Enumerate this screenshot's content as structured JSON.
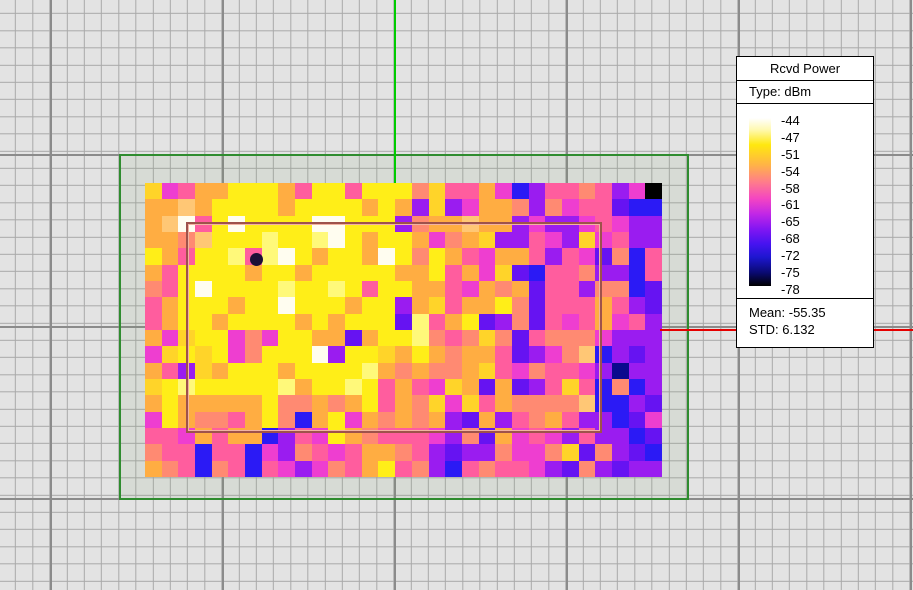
{
  "legend": {
    "title": "Rcvd Power",
    "type_label": "Type: dBm",
    "unit": "dBm",
    "ticks": [
      "-44",
      "-47",
      "-51",
      "-54",
      "-58",
      "-61",
      "-65",
      "-68",
      "-72",
      "-75",
      "-78"
    ],
    "mean_label": "Mean: -55.35",
    "std_label": "STD: 6.132",
    "mean_value": "-55.35",
    "std_value": "6.132",
    "gradient_stops": [
      {
        "color": "#ffffff",
        "pos": 0
      },
      {
        "color": "#fff9b0",
        "pos": 7
      },
      {
        "color": "#ffe80f",
        "pos": 16
      },
      {
        "color": "#ffb347",
        "pos": 28
      },
      {
        "color": "#ff7d8a",
        "pos": 38
      },
      {
        "color": "#f445c2",
        "pos": 48
      },
      {
        "color": "#c227e6",
        "pos": 57
      },
      {
        "color": "#8316f2",
        "pos": 66
      },
      {
        "color": "#4613f0",
        "pos": 75
      },
      {
        "color": "#1d16cf",
        "pos": 83
      },
      {
        "color": "#0a0a72",
        "pos": 92
      },
      {
        "color": "#000000",
        "pos": 100
      }
    ]
  },
  "colors": {
    "background": "#e3e3e3",
    "grid_minor": "#a9a9a9",
    "grid_major": "#8b8b8b",
    "boundary_outline": "#2f8c2f",
    "room_outline": "#9e524b",
    "room_outline_highlight": "#f2b3a2",
    "vertical_axis_line": "#00cc00",
    "horizontal_axis_line": "#e60000",
    "marker_dot": "#1c1036"
  },
  "heatmap": {
    "columns": 31,
    "row_count": 18,
    "marker_cell": {
      "col": 6,
      "row": 4
    },
    "palette": {
      "W": "#fffdf0",
      "Y": "#ffee18",
      "y": "#fff97a",
      "G": "#ffd429",
      "O": "#ffad42",
      "o": "#ffc775",
      "S": "#ff8a72",
      "P": "#ff5d9e",
      "M": "#ee3ed0",
      "V": "#9a1cf0",
      "U": "#6613f2",
      "B": "#2b1af5",
      "D": "#0a0a8e",
      "K": "#000000"
    },
    "rows": [
      "GMPOOYYYOPYYPYYYSGPPOMBVPPSPVMK",
      "OOoOYYYYOYYYYOYOVGVMOOSVSMPPUBB",
      "OoWPYWYYYYWWYYYVSOOoOOVMVVMPMVV",
      "OOSoYYYyYYyWYOYYOMSOGVVPMVGMPVV",
      "YOPYYyPyWYOYYOWYSYOPMOOPVPMUSBP",
      "OPYYYYOYYOYYYYYOOYPOMGUBPPSVVBP",
      "SPYWYYYYyYYyYPYYOOPMOSOUPPVSSBU",
      "POYYYOYYWYYYOYYVOGPOOYSUPPPOPVU",
      "POYYOYYYYOYOYYYUyPOYUVSUPMPOMPV",
      "OMGYYMSMYYOOUOYYySPSGSUPSSSMVVV",
      "MGYGYMSYYYWVYYGOYOSOOPUVMSoBVUV",
      "OPVGOYYYOYYYYyOSOSSOGPMSPPMVDVV",
      "GYyYYYYYyOYYyYPOPMGOUOUVPGPBSBV",
      "OYOOOOOYSSOSOYPOSGMGPOSSSSoBBVU",
      "MYOSSPOYSBOYMOSOSOVUOVPSOPVVBUM",
      "PPMOPOOBVPMYOSPPPMVSUOMPMVPVVBU",
      "SPPBPPBMVSPMPOOSPVUVVSMMSGUSVUB",
      "OSPBSPBPMVMSPOYPSVBPSPPMVUSVUVV"
    ]
  }
}
